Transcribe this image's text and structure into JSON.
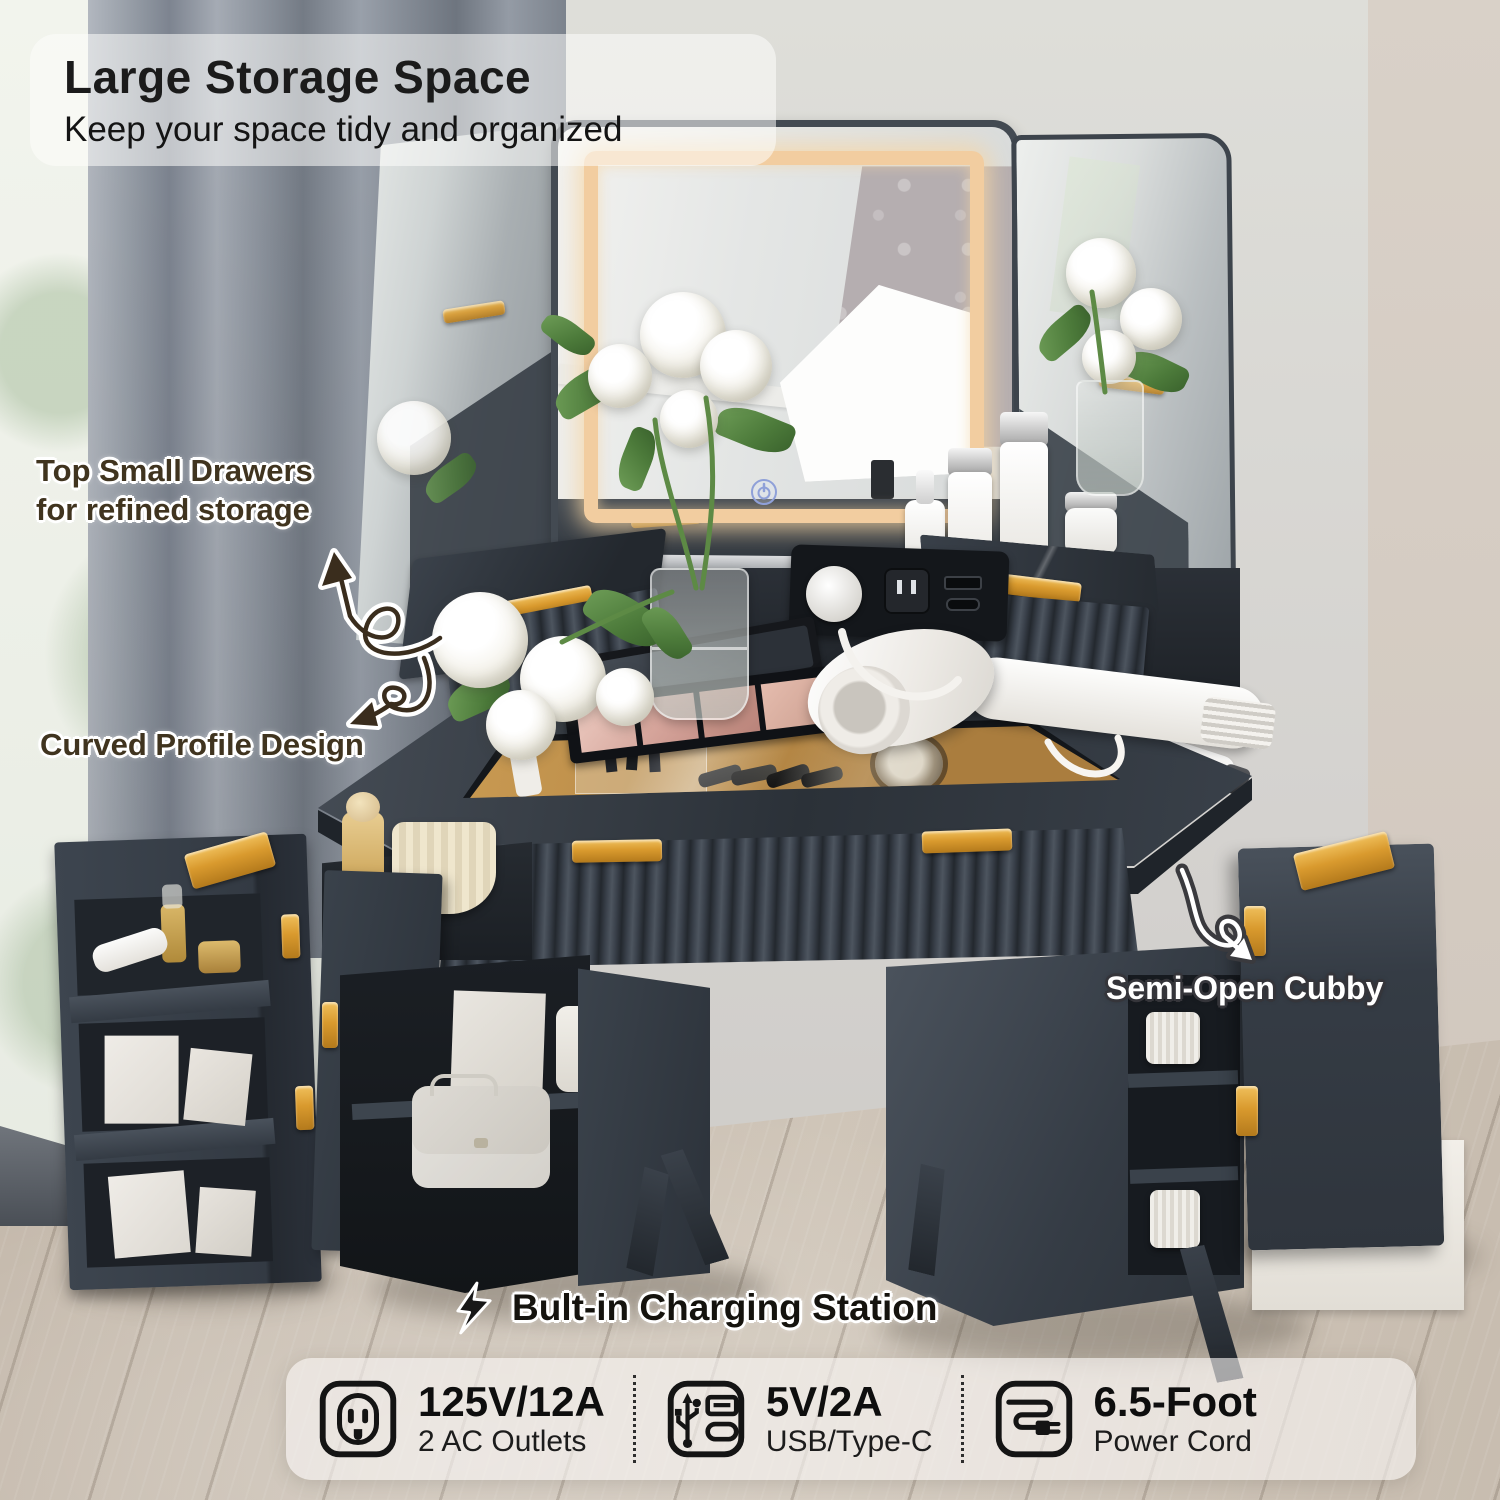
{
  "title": {
    "heading": "Large Storage Space",
    "subheading": "Keep your space tidy and organized"
  },
  "callouts": {
    "top_drawers_line1": "Top Small Drawers",
    "top_drawers_line2": "for refined storage",
    "curved_profile": "Curved Profile Design",
    "semi_open_cubby": "Semi-Open Cubby"
  },
  "charging_station": {
    "heading": "Bult-in Charging Station",
    "icon": "lightning-icon",
    "specs": [
      {
        "icon": "ac-outlet-icon",
        "value": "125V/12A",
        "label": "2 AC Outlets"
      },
      {
        "icon": "usb-type-c-icon",
        "value": "5V/2A",
        "label": "USB/Type-C"
      },
      {
        "icon": "power-cord-icon",
        "value": "6.5-Foot",
        "label": "Power Cord"
      }
    ]
  },
  "colors": {
    "accent_gold": "#d9992e",
    "led_glow": "#f4d0a6",
    "furniture_charcoal": "#353c45"
  }
}
